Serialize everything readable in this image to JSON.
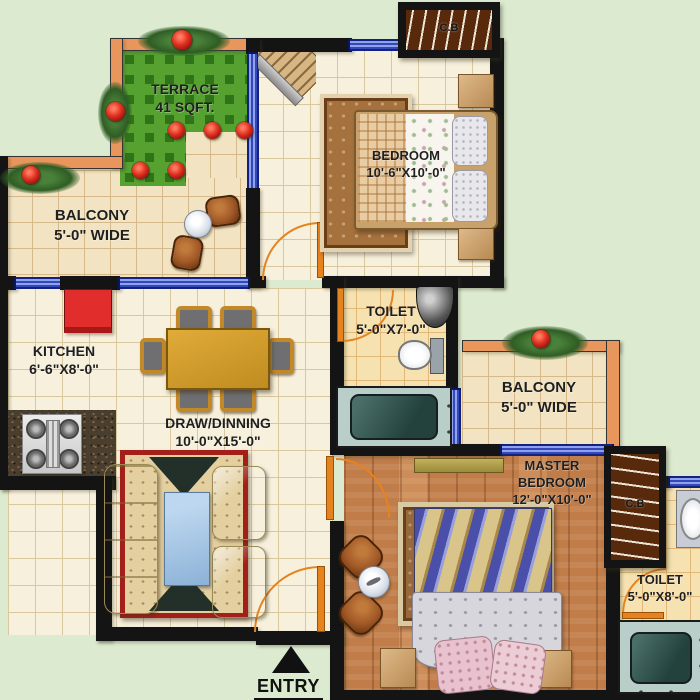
{
  "rooms": {
    "terrace": {
      "name": "TERRACE",
      "size": "41 SQFT."
    },
    "balcony_left": {
      "name": "BALCONY",
      "size": "5'-0\" WIDE"
    },
    "bedroom": {
      "name": "BEDROOM",
      "size": "10'-6\"X10'-0\""
    },
    "kitchen": {
      "name": "KITCHEN",
      "size": "6'-6\"X8'-0\""
    },
    "toilet_1": {
      "name": "TOILET",
      "size": "5'-0\"X7'-0\""
    },
    "draw_dining": {
      "name": "DRAW/DINNING",
      "size": "10'-0\"X15'-0\""
    },
    "balcony_right": {
      "name": "BALCONY",
      "size": "5'-0\" WIDE"
    },
    "master_bedroom": {
      "name": "MASTER BEDROOM",
      "size": "12'-0\"X10'-0\""
    },
    "toilet_2": {
      "name": "TOILET",
      "size": "5'-0\"X8'-0\""
    }
  },
  "cupboards": {
    "bedroom": {
      "label": "C.B"
    },
    "master": {
      "label": "C.B"
    }
  },
  "entry": {
    "label": "ENTRY"
  },
  "colors": {
    "background": "#dcead0",
    "terrace_green": "#55a231",
    "wall_black": "#141414",
    "outer_wall_orange": "#e8965c",
    "window_blue": "#3448b8",
    "door_orange": "#e5831f",
    "wood_floor": "#c07c49",
    "tile_cream": "#f7f0dc",
    "kitchen_red": "#e22d2d",
    "bathtub_teal": "#23423e"
  }
}
